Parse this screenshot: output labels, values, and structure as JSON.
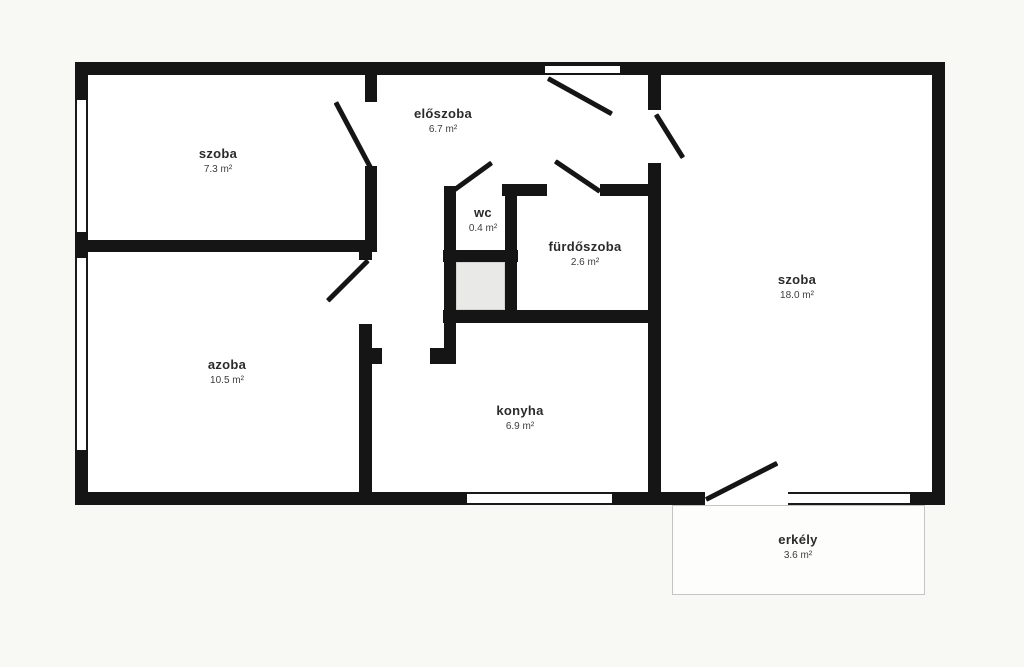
{
  "plan_type": "apartment-floor-plan",
  "colors": {
    "background": "#f8f8f5",
    "wall": "#151515",
    "room_fill": "#ffffff",
    "shaft_fill": "#e9e9e7",
    "balcony_border": "#c4c4c2",
    "label_text": "#2b2b2b"
  },
  "rooms": [
    {
      "label": "szoba",
      "area": "7.3 m²"
    },
    {
      "label": "előszoba",
      "area": "6.7 m²"
    },
    {
      "label": "wc",
      "area": "0.4 m²"
    },
    {
      "label": "fürdőszoba",
      "area": "2.6 m²"
    },
    {
      "label": "szoba",
      "area": "18.0 m²"
    },
    {
      "label": "azoba",
      "area": "10.5 m²"
    },
    {
      "label": "konyha",
      "area": "6.9 m²"
    },
    {
      "label": "erkély",
      "area": "3.6 m²"
    }
  ]
}
